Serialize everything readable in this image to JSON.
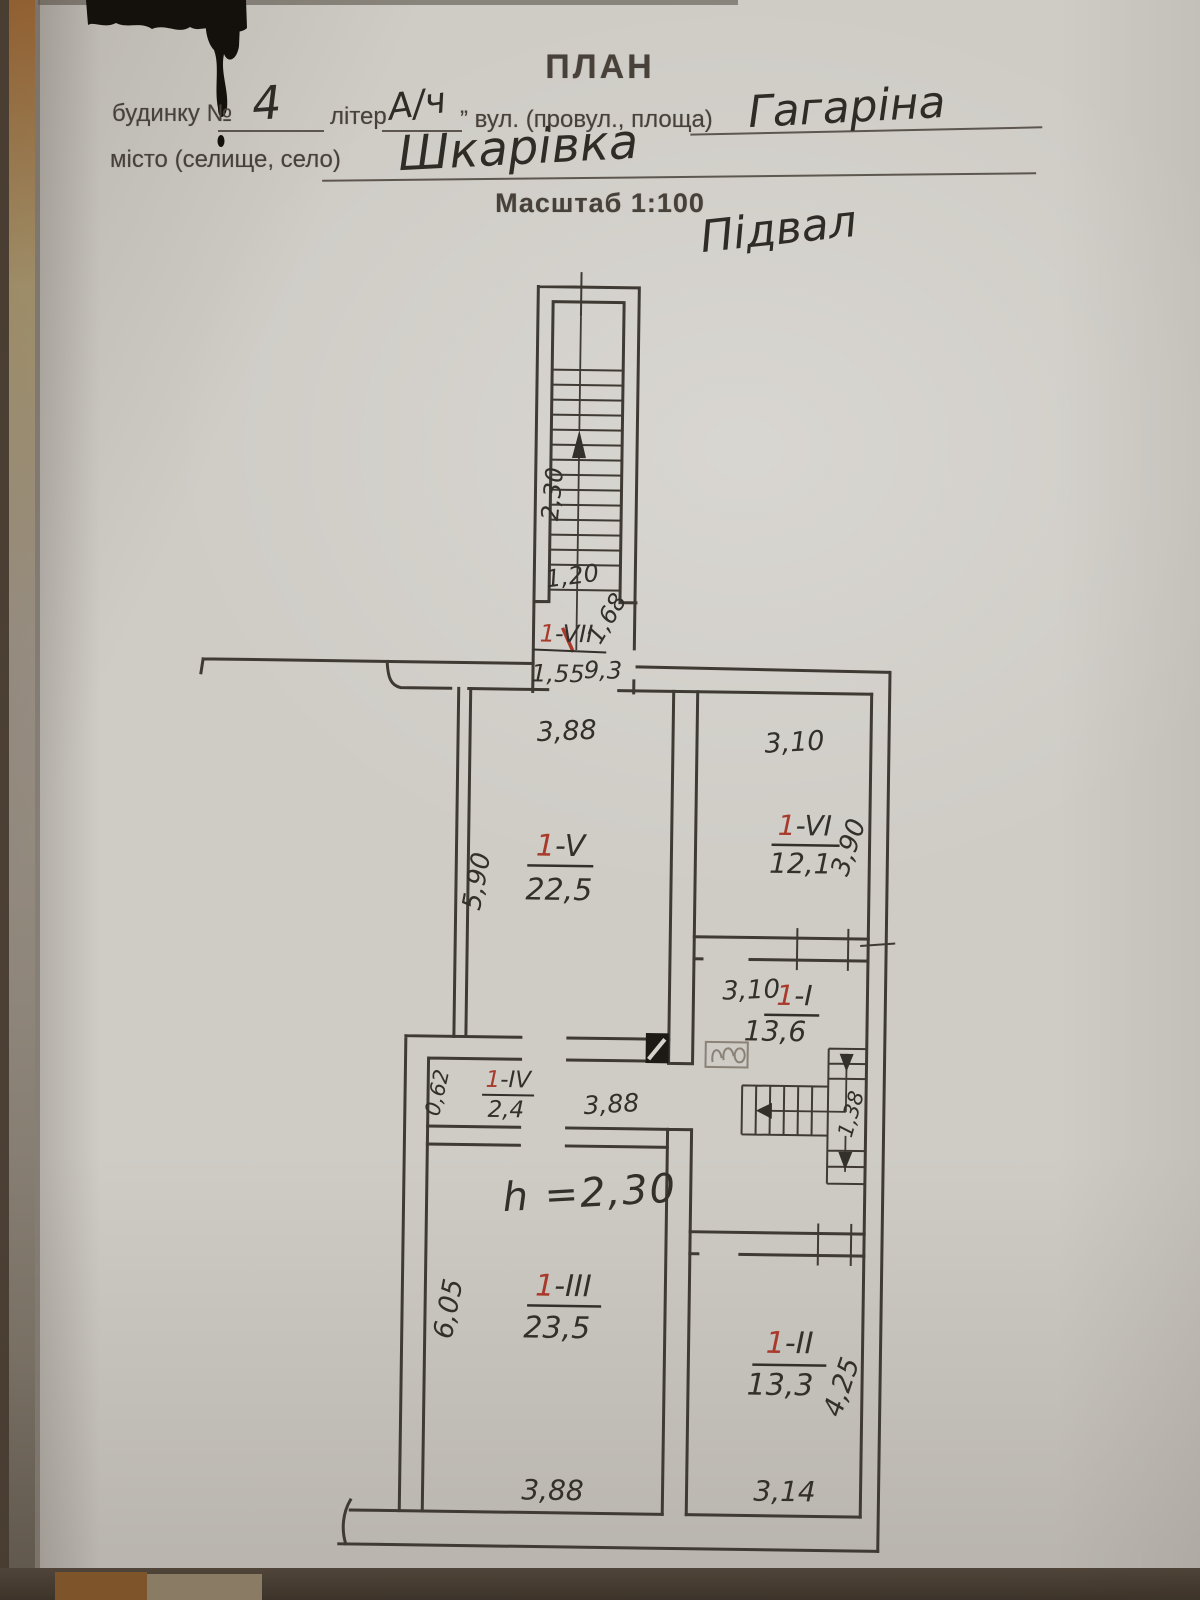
{
  "header": {
    "title": "ПЛАН",
    "building_label": "будинку №",
    "building_value": "4",
    "letter_label": "літер",
    "letter_value": "А/ч",
    "street_label": "” вул. (провул., площа)",
    "street_value": "Гагаріна",
    "city_label": "місто (селище, село)",
    "city_value": "Шкарівка",
    "scale_label": "Масштаб 1:100",
    "floor_note": "Підвал"
  },
  "plan": {
    "entry_stair": {
      "length": "2,30",
      "width": "1,20"
    },
    "vestibule": {
      "no": "1",
      "suffix": "-VII",
      "width": "1,55",
      "area": "9,3",
      "depth": "1,68"
    },
    "room_v": {
      "no": "1",
      "suffix": "-V",
      "area": "22,5",
      "top": "3,88",
      "left": "5,90"
    },
    "room_vi": {
      "no": "1",
      "suffix": "-VI",
      "area": "12,1",
      "top": "3,10",
      "right": "3,90"
    },
    "room_i": {
      "no": "1",
      "suffix": "-I",
      "area": "13,6",
      "top": "3,10"
    },
    "corridor": {
      "no": "1",
      "suffix": "-IV",
      "area": "2,4",
      "left": "0,62",
      "width": "3,88"
    },
    "room_iii": {
      "no": "1",
      "suffix": "-III",
      "area": "23,5",
      "left": "6,05",
      "bottom": "3,88",
      "height_note": "h =2,30"
    },
    "room_ii": {
      "no": "1",
      "suffix": "-II",
      "area": "13,3",
      "right": "4,25",
      "bottom": "3,14"
    },
    "inner_stair": {
      "width": "1,38"
    }
  },
  "colors": {
    "ink": "#33302b",
    "red": "#a83a2c",
    "line": "#3f3a33",
    "pencil": "#8a8177"
  }
}
